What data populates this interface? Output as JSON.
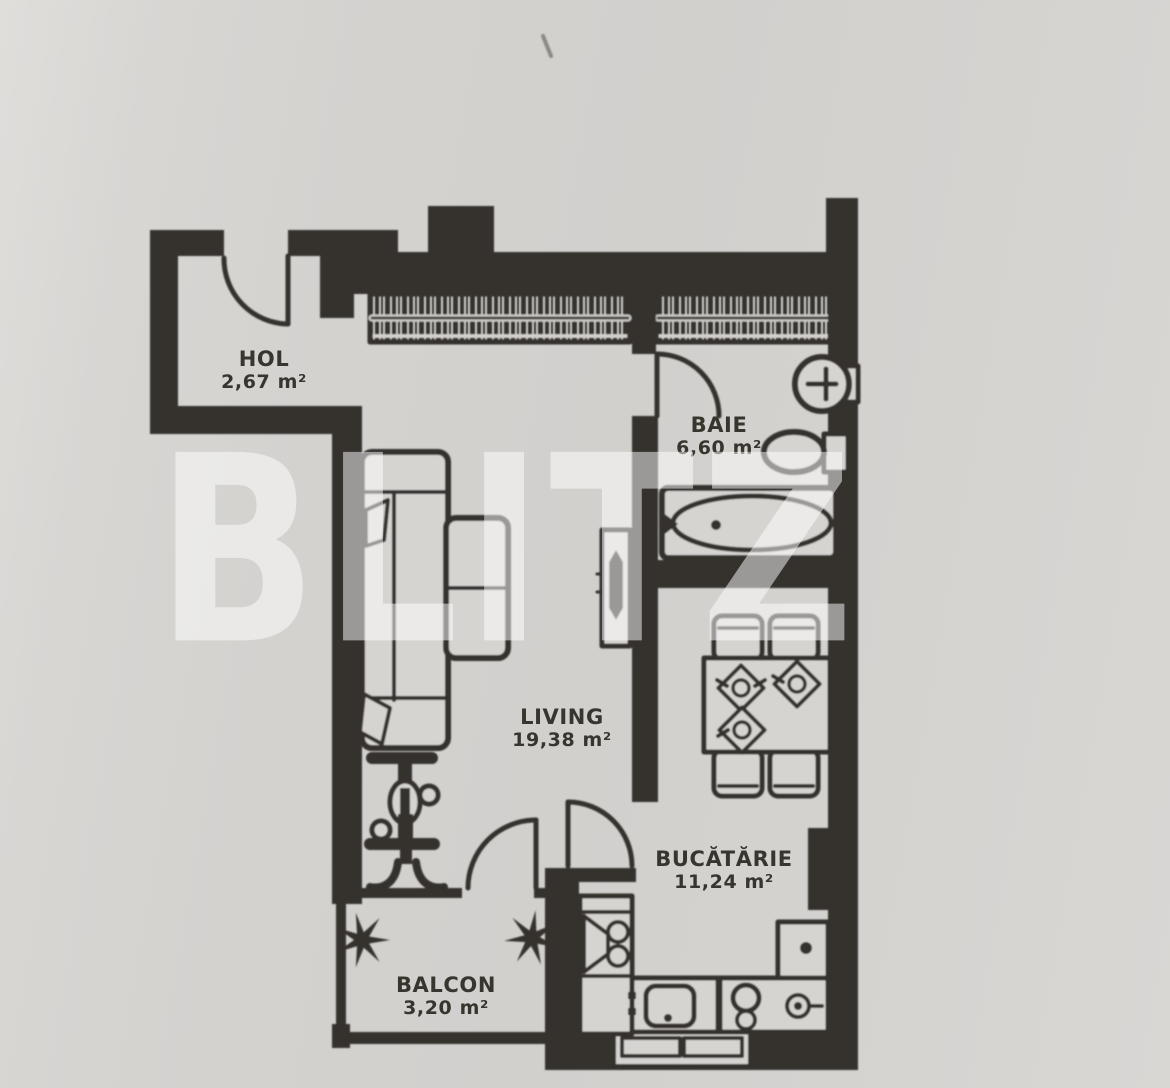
{
  "watermark": {
    "text": "BLITZ"
  },
  "rooms": [
    {
      "name": "HOL",
      "area": "2,67 m²"
    },
    {
      "name": "BAIE",
      "area": "6,60 m²"
    },
    {
      "name": "LIVING",
      "area": "19,38 m²"
    },
    {
      "name": "BUCĂTĂRIE",
      "area": "11,24 m²"
    },
    {
      "name": "BALCON",
      "area": "3,20 m²"
    }
  ],
  "colors": {
    "paper": "#d6d4d1",
    "ink": "#34312d",
    "label": "#38352f",
    "watermark": "rgba(255,255,255,0.5)"
  },
  "fixtures": [
    "entry-door",
    "wardrobe",
    "interior-door",
    "sofa",
    "tv-unit",
    "exercise-bike",
    "bathtub",
    "toilet",
    "sink",
    "dining-table",
    "chair",
    "place-setting",
    "fridge",
    "kitchen-counter",
    "kitchen-sink",
    "stove",
    "washing-machine",
    "window",
    "plant",
    "balcony-railing"
  ]
}
